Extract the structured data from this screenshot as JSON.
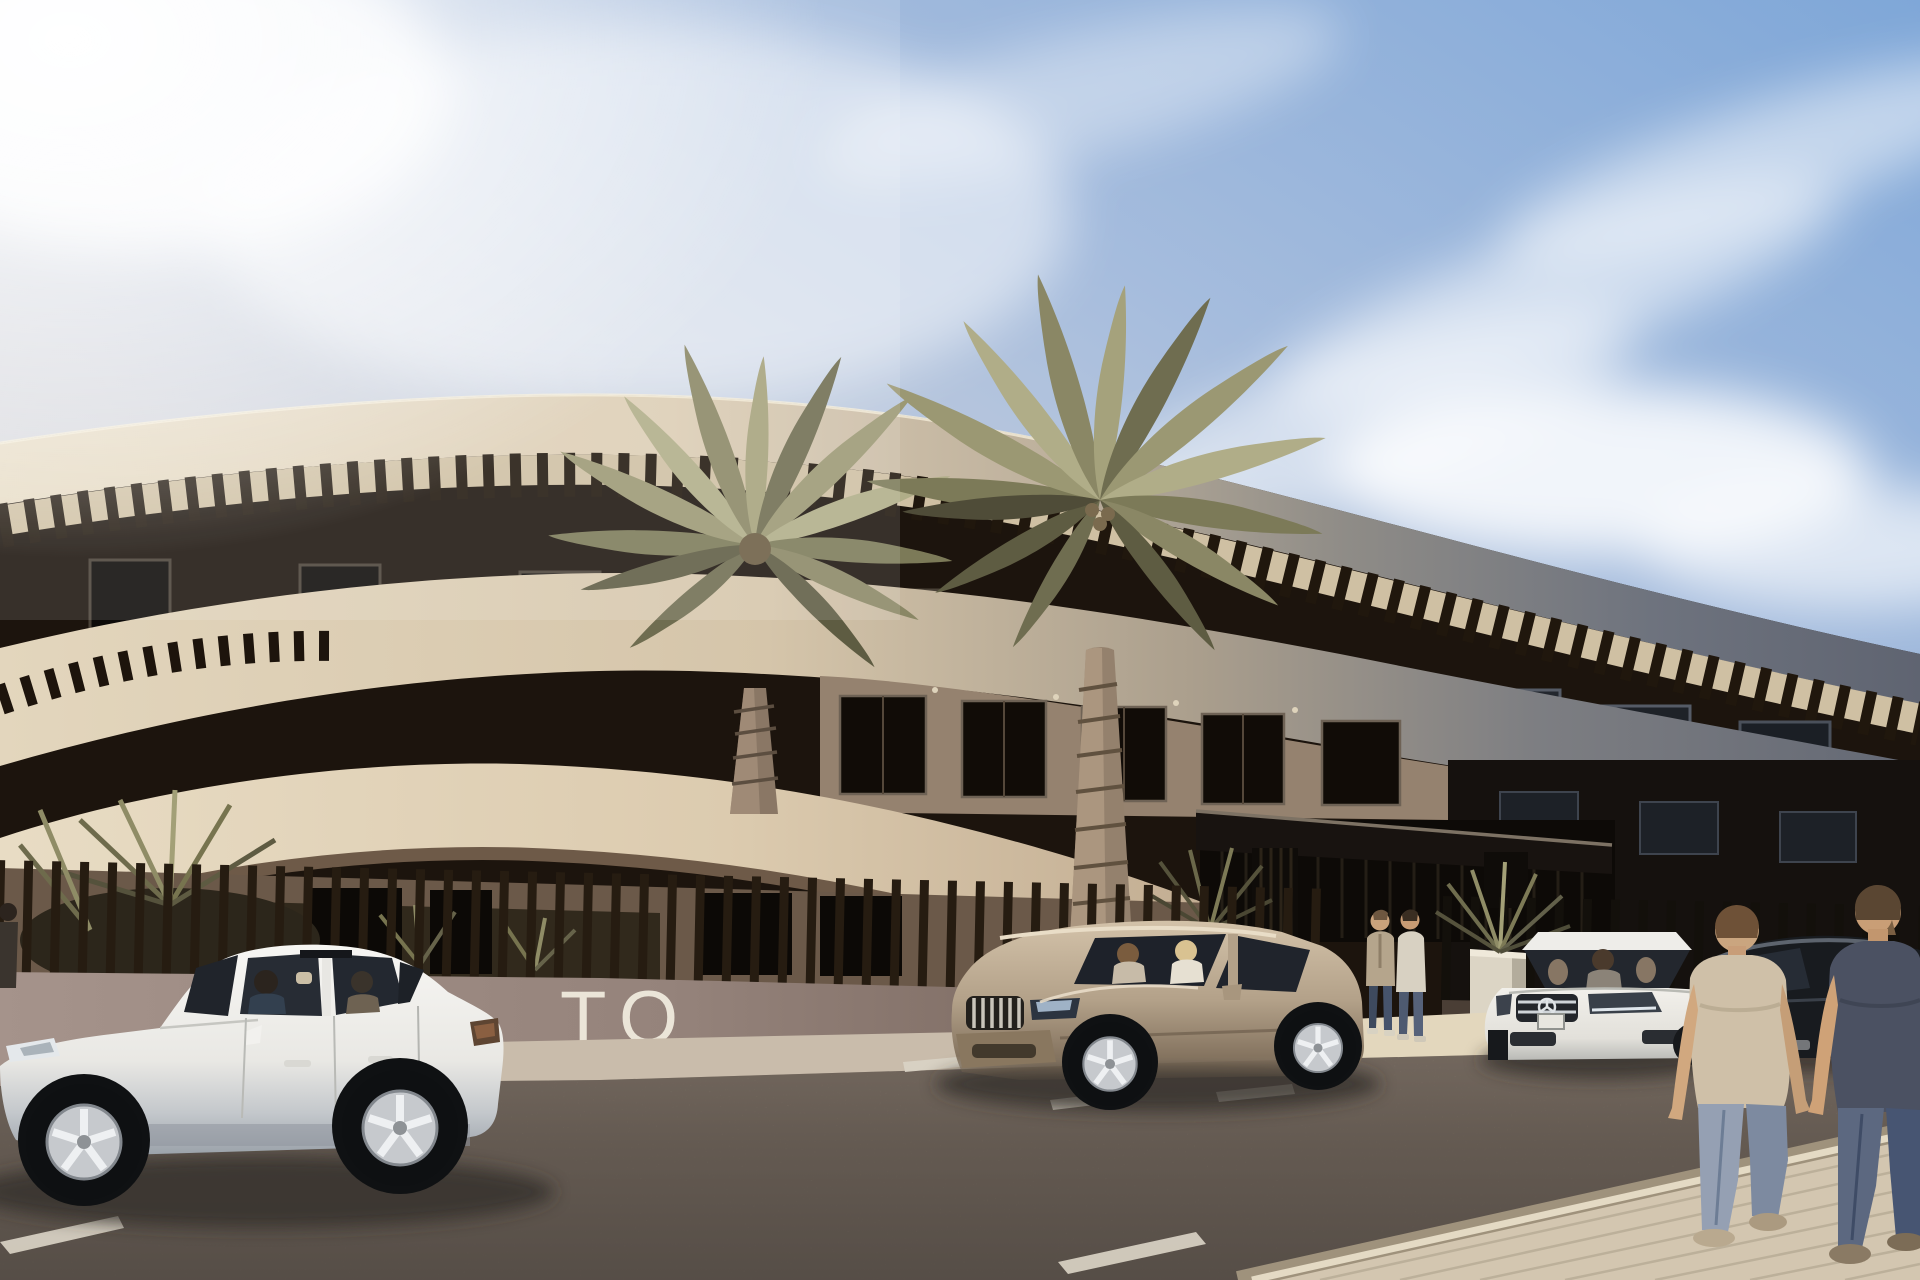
{
  "meta": {
    "title": "New-build apartment complex — sunny street architectural render"
  },
  "scene": {
    "wall_sign_text": "TO",
    "setting": "Photorealistic 3D visualization of a curved modern apartment building with cream fascia bands, dark recessed glazing, palm trees, parked cars and pedestrians on a sunny day",
    "sky": {
      "clouds": "wispy diagonal cirrus in upper right",
      "glare": "bright sun haze in upper left"
    },
    "building": {
      "floors_visible": 3,
      "style": "sweeping elliptical cream balcony bands, dark pergola slats, bronze vertical-slat fence on a low rendered wall",
      "entrance": "flat dark canopy on louvred slat columns with white planter"
    },
    "vehicles": [
      {
        "label": "white-sedan-side-view",
        "color_hex": "#eceae6"
      },
      {
        "label": "champagne-suv-three-quarter",
        "color_hex": "#b4a28a"
      },
      {
        "label": "white-mercedes-front-view",
        "color_hex": "#eae8e3"
      },
      {
        "label": "dark-car-right-edge",
        "color_hex": "#191c20"
      }
    ],
    "people": [
      {
        "label": "sedan-driver"
      },
      {
        "label": "sedan-rear-passenger"
      },
      {
        "label": "suv-passenger"
      },
      {
        "label": "suv-driver-blonde"
      },
      {
        "label": "mercedes-driver"
      },
      {
        "label": "standing-man-beige-cardigan"
      },
      {
        "label": "standing-man-cream-sweater"
      },
      {
        "label": "walking-man-beige-tshirt"
      },
      {
        "label": "walking-man-slate-tshirt"
      },
      {
        "label": "figure-left-edge"
      }
    ],
    "vegetation": {
      "large_palms": 2,
      "small_palm_clusters": 4
    },
    "road": {
      "markings": [
        "parking bay dashes",
        "diagonal lane dashes",
        "line near entrance"
      ],
      "sidewalk": "beige paver sidewalk lower right"
    },
    "palette": {
      "sky_blue": "#85abd9",
      "haze": "#e9e6e2",
      "facade_cream": "#e0d4bd",
      "facade_shadow_grey": "#6b7079",
      "recess_dark": "#1d150e",
      "fence_dark": "#261c11",
      "wall_mauve": "#9b8a82",
      "road": "#7b7065",
      "sidewalk": "#d2c5af",
      "canopy_dark": "#191410"
    }
  }
}
